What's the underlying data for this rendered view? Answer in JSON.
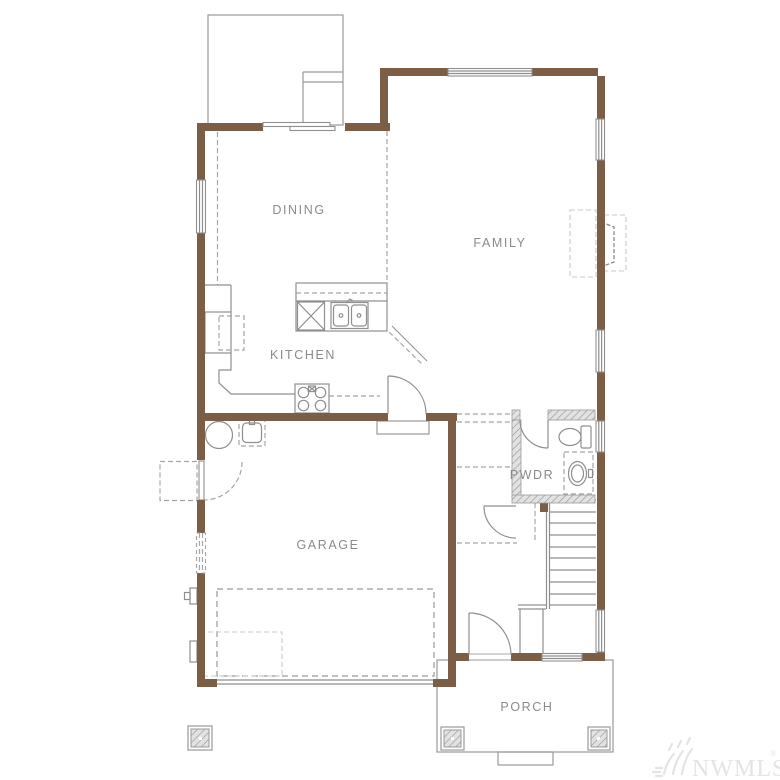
{
  "plan": {
    "type": "floor-plan",
    "rooms": {
      "dining": "DINING",
      "family": "FAMILY",
      "kitchen": "KITCHEN",
      "garage": "GARAGE",
      "powder": "PWDR",
      "porch": "PORCH"
    }
  },
  "watermark": {
    "text": "NWMLS",
    "registered": "®"
  },
  "colors": {
    "background": "#FFFFFF",
    "wall": "#7B5E45",
    "line": "#8F8F8F",
    "dashed": "#A5A5A5",
    "hatch": "#9C9C9C",
    "label": "#8B8B8B",
    "watermark": "#E3E4E6"
  }
}
